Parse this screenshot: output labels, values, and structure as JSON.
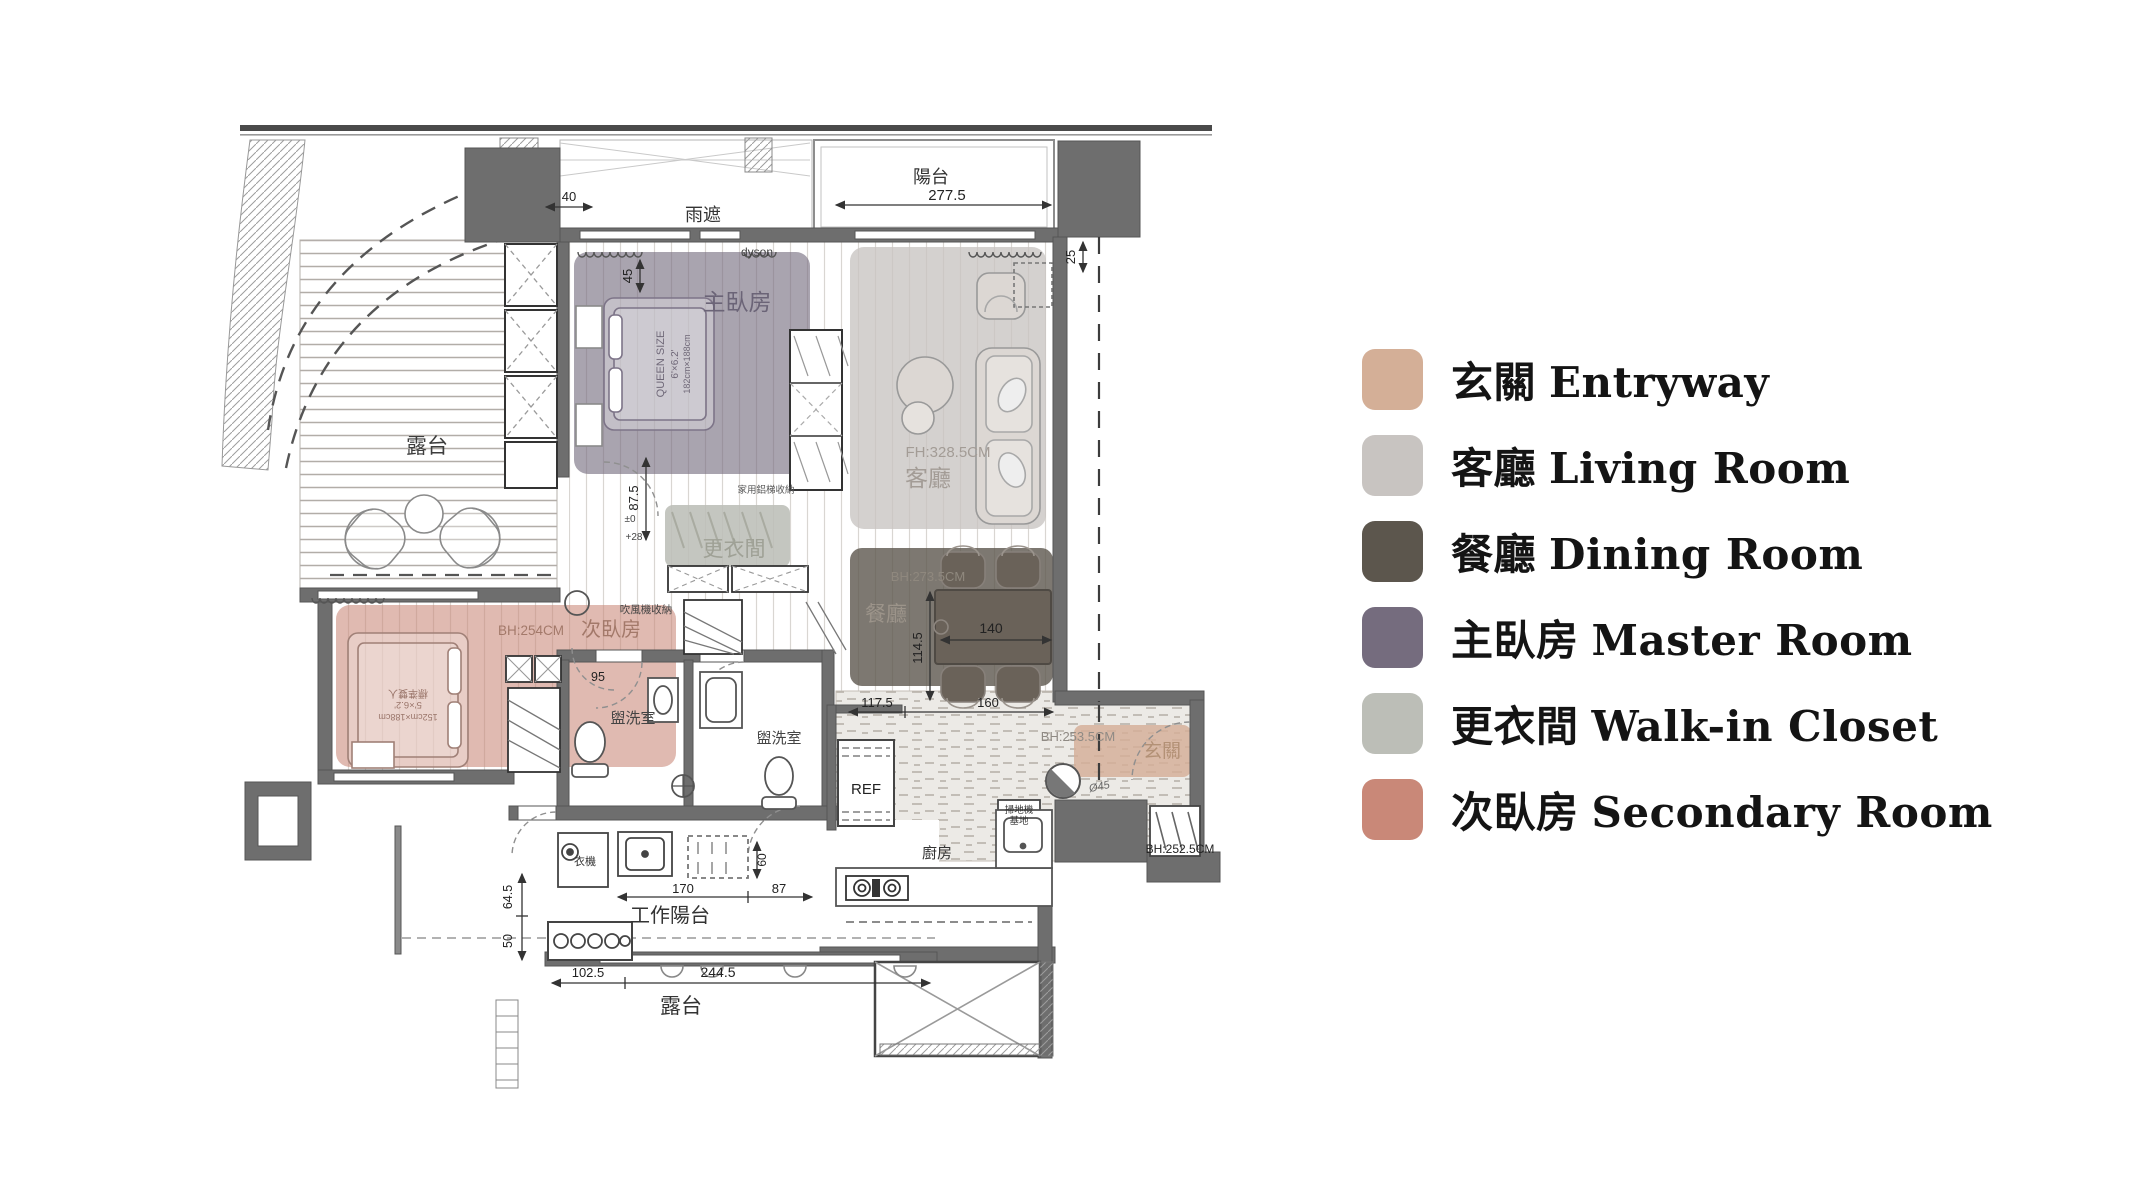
{
  "legend": {
    "items": [
      {
        "zh": "玄關",
        "en": "Entryway",
        "color": "#d4af97"
      },
      {
        "zh": "客廳",
        "en": "Living Room",
        "color": "#c8c4c1"
      },
      {
        "zh": "餐廳",
        "en": "Dining Room",
        "color": "#5c564d"
      },
      {
        "zh": "主臥房",
        "en": "Master Room",
        "color": "#756c7e"
      },
      {
        "zh": "更衣間",
        "en": "Walk-in Closet",
        "color": "#bcbeb7"
      },
      {
        "zh": "次臥房",
        "en": "Secondary Room",
        "color": "#c98878"
      }
    ]
  },
  "plan": {
    "rooms": {
      "balcony_top": "陽台",
      "canopy": "雨遮",
      "master": "主臥房",
      "terrace_left": "露台",
      "living_fh": "FH:328.5CM",
      "living": "客廳",
      "dining_bh": "BH:273.5CM",
      "dining": "餐廳",
      "closet": "更衣間",
      "secondary_bh": "BH:254CM",
      "secondary": "次臥房",
      "bath_secondary": "盥洗室",
      "bath_main": "盥洗室",
      "fridge": "REF",
      "kitchen": "廚房",
      "entry": "玄關",
      "entry_bh": "BH:253.5CM",
      "shoe_bh": "BH:252.5CM",
      "work_balcony": "工作陽台",
      "terrace_bottom": "露台"
    },
    "annotations": {
      "dyson": "dyson",
      "washer": "衣機",
      "hair_dryer": "吹風機收納",
      "ladder_storage": "家用鋁梯收納",
      "vacuum_dock_line1": "掃地機",
      "vacuum_dock_line2": "基地",
      "table_dia": "Ø45",
      "level_zero": "±0",
      "level_28": "+28",
      "bed_master_line1": "QUEEN SIZE",
      "bed_master_line2": "6'×6.2'",
      "bed_master_line3": "182cm×188cm",
      "bed_secondary_line1": "標準雙人",
      "bed_secondary_line2": "5'×6.2'",
      "bed_secondary_line3": "152cm×188cm"
    },
    "dims": {
      "canopy_offset": "40",
      "balcony_width": "277.5",
      "right_offset": "25",
      "master_top": "45",
      "master_bottom": "87.5",
      "secondary_door": "95",
      "dining_table": "140",
      "dining_depth": "114.5",
      "kitchen_left": "117.5",
      "kitchen_right": "160",
      "work_left": "170",
      "work_right": "87",
      "bath_door": "60",
      "left_upper": "64.5",
      "left_lower": "50",
      "terrace_w1": "102.5",
      "terrace_w2": "244.5"
    }
  }
}
